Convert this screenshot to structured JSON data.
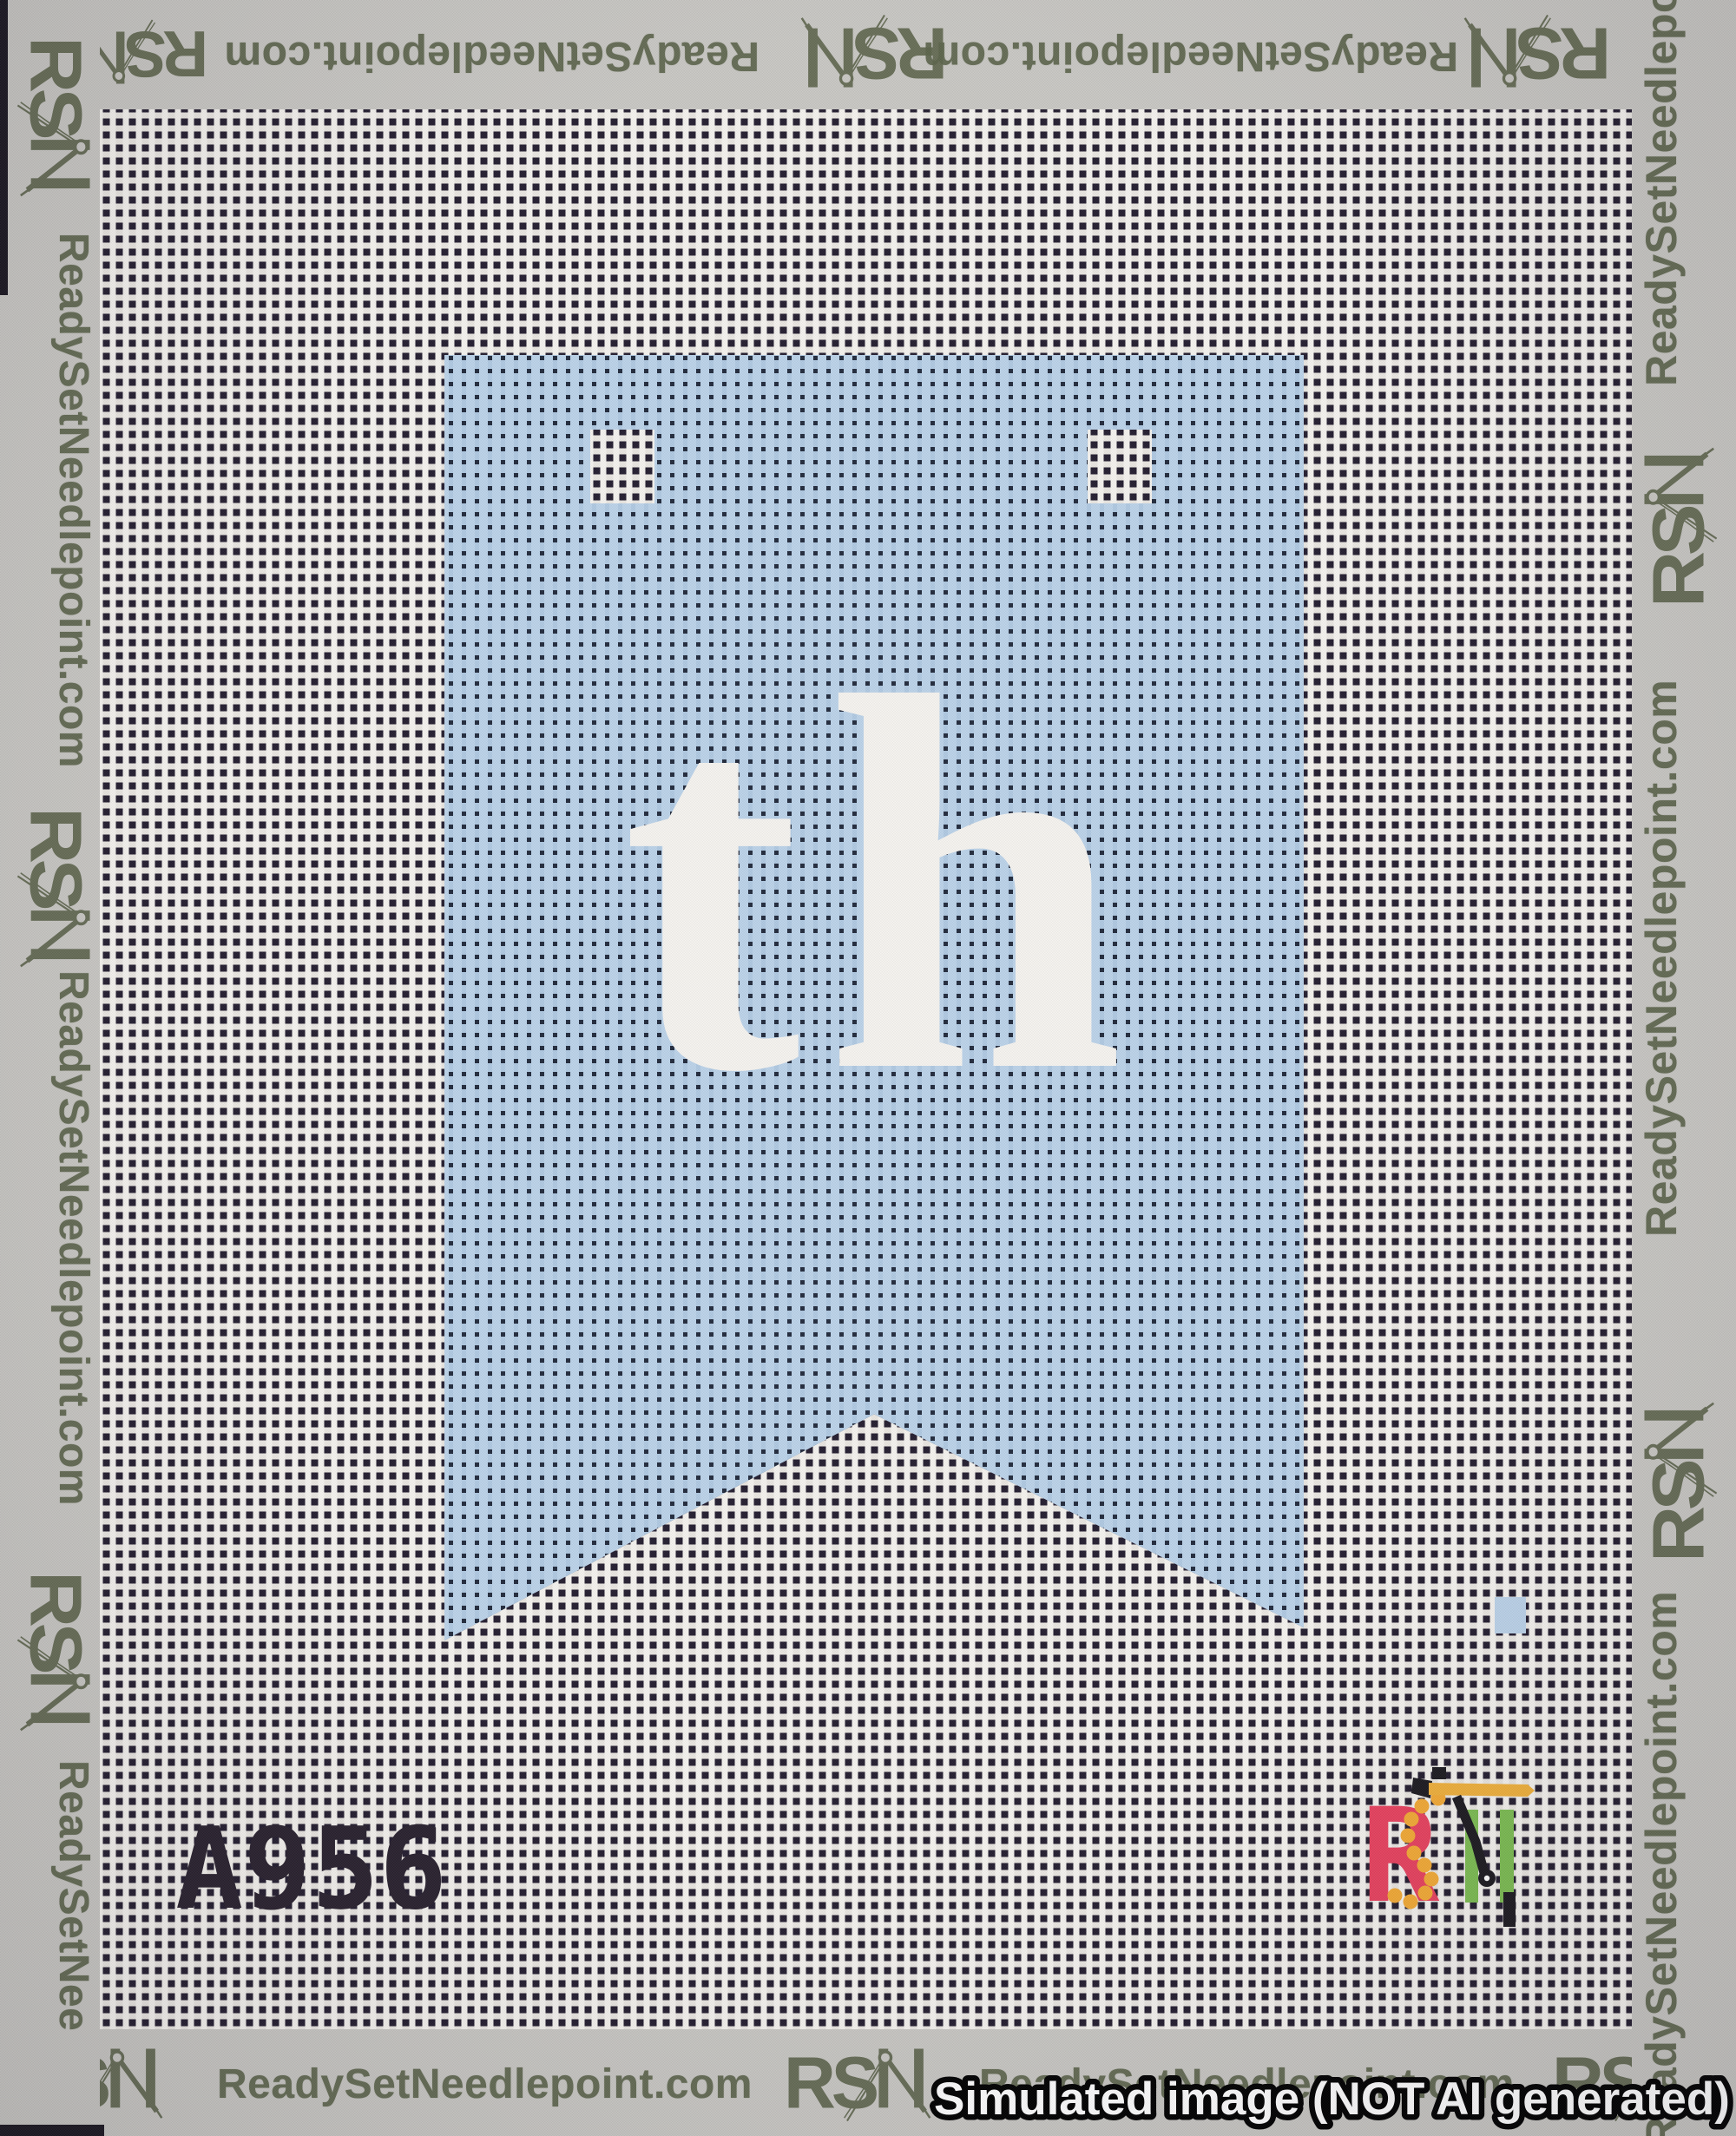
{
  "brand": {
    "initials": "RSN",
    "url": "ReadySetNeedlepoint.com",
    "url_partial": "ReadySetNee",
    "ink_color": "#5c644b",
    "selvage_color": "#c8c7c3"
  },
  "mesh": {
    "thread_color": "#f4f2ee",
    "thread_shade_color": "#e9e6e0",
    "hole_color": "#241e2f"
  },
  "design": {
    "monogram": "th",
    "monogram_color": "#f5f3ef",
    "banner_blue": "#bcd3e9",
    "banner_blue_shade": "#b0c9e1",
    "banner_hole_color": "#222a3c",
    "sku": "A956",
    "sku_color": "#29222e"
  },
  "stitched_logo": {
    "r_color": "#e8425f",
    "s_color": "#f3ab36",
    "n_color": "#7cbd52",
    "needle_color": "#1c1a20",
    "gold_color": "#f0b13c"
  },
  "watermark": {
    "text": "Simulated image (NOT AI generated)",
    "fill": "#ffffff",
    "outline": "#000000"
  }
}
